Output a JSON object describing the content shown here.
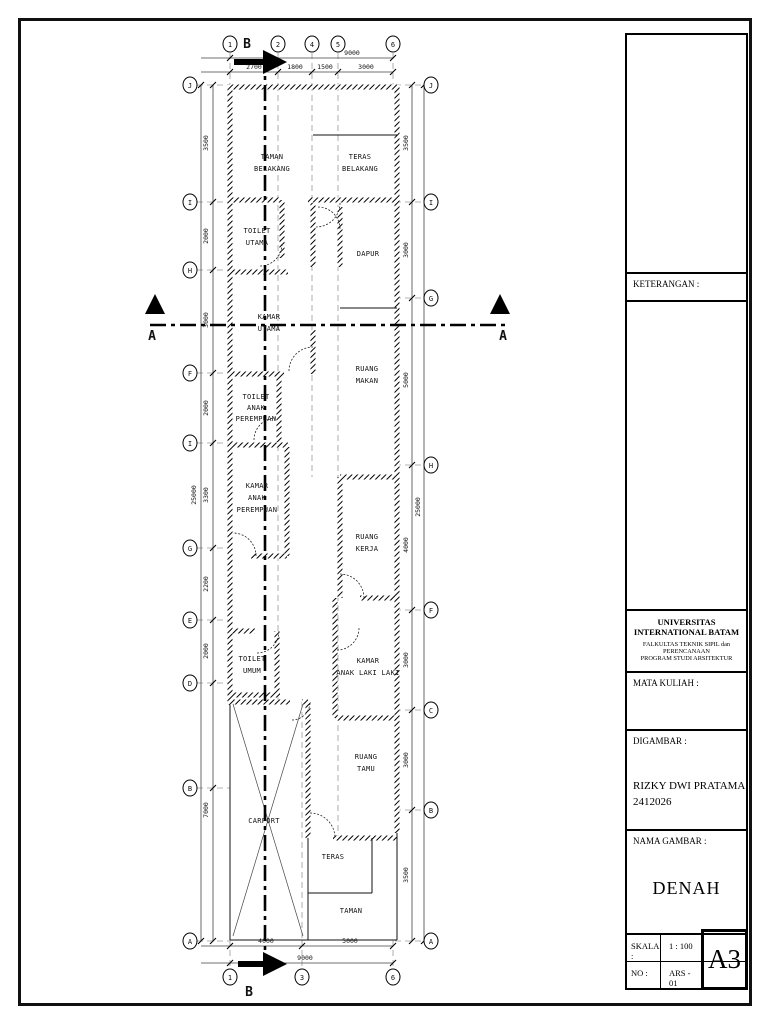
{
  "title_block": {
    "keterangan_label": "KETERANGAN :",
    "university": "UNIVERSITAS INTERNATIONAL BATAM",
    "faculty_line1": "FALKULTAS TEKNIK SIPIL dan PERENCANAAN",
    "faculty_line2": "PROGRAM STUDI ARSITEKTUR",
    "mata_kuliah_label": "MATA KULIAH :",
    "digambar_label": "DIGAMBAR :",
    "author_name": "RIZKY DWI PRATAMA",
    "author_id": "2412026",
    "nama_gambar_label": "NAMA GAMBAR :",
    "drawing_title": "DENAH",
    "skala_label": "SKALA :",
    "skala_value": "1 : 100",
    "no_label": "NO :",
    "no_value": "ARS - 01",
    "paper_size": "A3"
  },
  "plan": {
    "section_labels": {
      "horizontal": "A",
      "vertical": "B"
    },
    "grid_top": [
      "1",
      "2",
      "4",
      "5",
      "6"
    ],
    "grid_bottom": [
      "1",
      "3",
      "6"
    ],
    "grid_left": [
      "J",
      "I",
      "H",
      "F",
      "I",
      "G",
      "E",
      "D",
      "B",
      "A"
    ],
    "grid_right": [
      "J",
      "I",
      "G",
      "H",
      "F",
      "C",
      "B",
      "A"
    ],
    "dims_top": {
      "overall": "9000",
      "segments": [
        "2700",
        "1800",
        "1500",
        "3000"
      ]
    },
    "dims_bottom": {
      "overall": "9000",
      "segments": [
        "4000",
        "5000"
      ]
    },
    "dims_left": {
      "overall": "25000",
      "segments": [
        "3500",
        "2000",
        "3000",
        "2000",
        "3300",
        "2200",
        "2000",
        "7000"
      ]
    },
    "dims_right": {
      "overall": "25000",
      "segments": [
        "3500",
        "3000",
        "5000",
        "4000",
        "3000",
        "3000",
        "3500"
      ]
    },
    "rooms": [
      {
        "name": "taman-belakang",
        "lines": [
          "TAMAN",
          "BELAKANG"
        ]
      },
      {
        "name": "teras-belakang",
        "lines": [
          "TERAS",
          "BELAKANG"
        ]
      },
      {
        "name": "toilet-utama",
        "lines": [
          "TOILET",
          "UTAMA"
        ]
      },
      {
        "name": "dapur",
        "lines": [
          "DAPUR"
        ]
      },
      {
        "name": "kamar-utama",
        "lines": [
          "KAMAR",
          "UTAMA"
        ]
      },
      {
        "name": "ruang-makan",
        "lines": [
          "RUANG",
          "MAKAN"
        ]
      },
      {
        "name": "toilet-anak-perempuan",
        "lines": [
          "TOILET",
          "ANAK",
          "PEREMPUAN"
        ]
      },
      {
        "name": "kamar-anak-perempuan",
        "lines": [
          "KAMAR",
          "ANAK",
          "PEREMPUAN"
        ]
      },
      {
        "name": "ruang-kerja",
        "lines": [
          "RUANG",
          "KERJA"
        ]
      },
      {
        "name": "toilet-umum",
        "lines": [
          "TOILET",
          "UMUM"
        ]
      },
      {
        "name": "kamar-anak-laki-laki",
        "lines": [
          "KAMAR",
          "ANAK LAKI LAKI"
        ]
      },
      {
        "name": "ruang-tamu",
        "lines": [
          "RUANG",
          "TAMU"
        ]
      },
      {
        "name": "carport",
        "lines": [
          "CARPORT"
        ]
      },
      {
        "name": "teras",
        "lines": [
          "TERAS"
        ]
      },
      {
        "name": "taman",
        "lines": [
          "TAMAN"
        ]
      }
    ]
  }
}
